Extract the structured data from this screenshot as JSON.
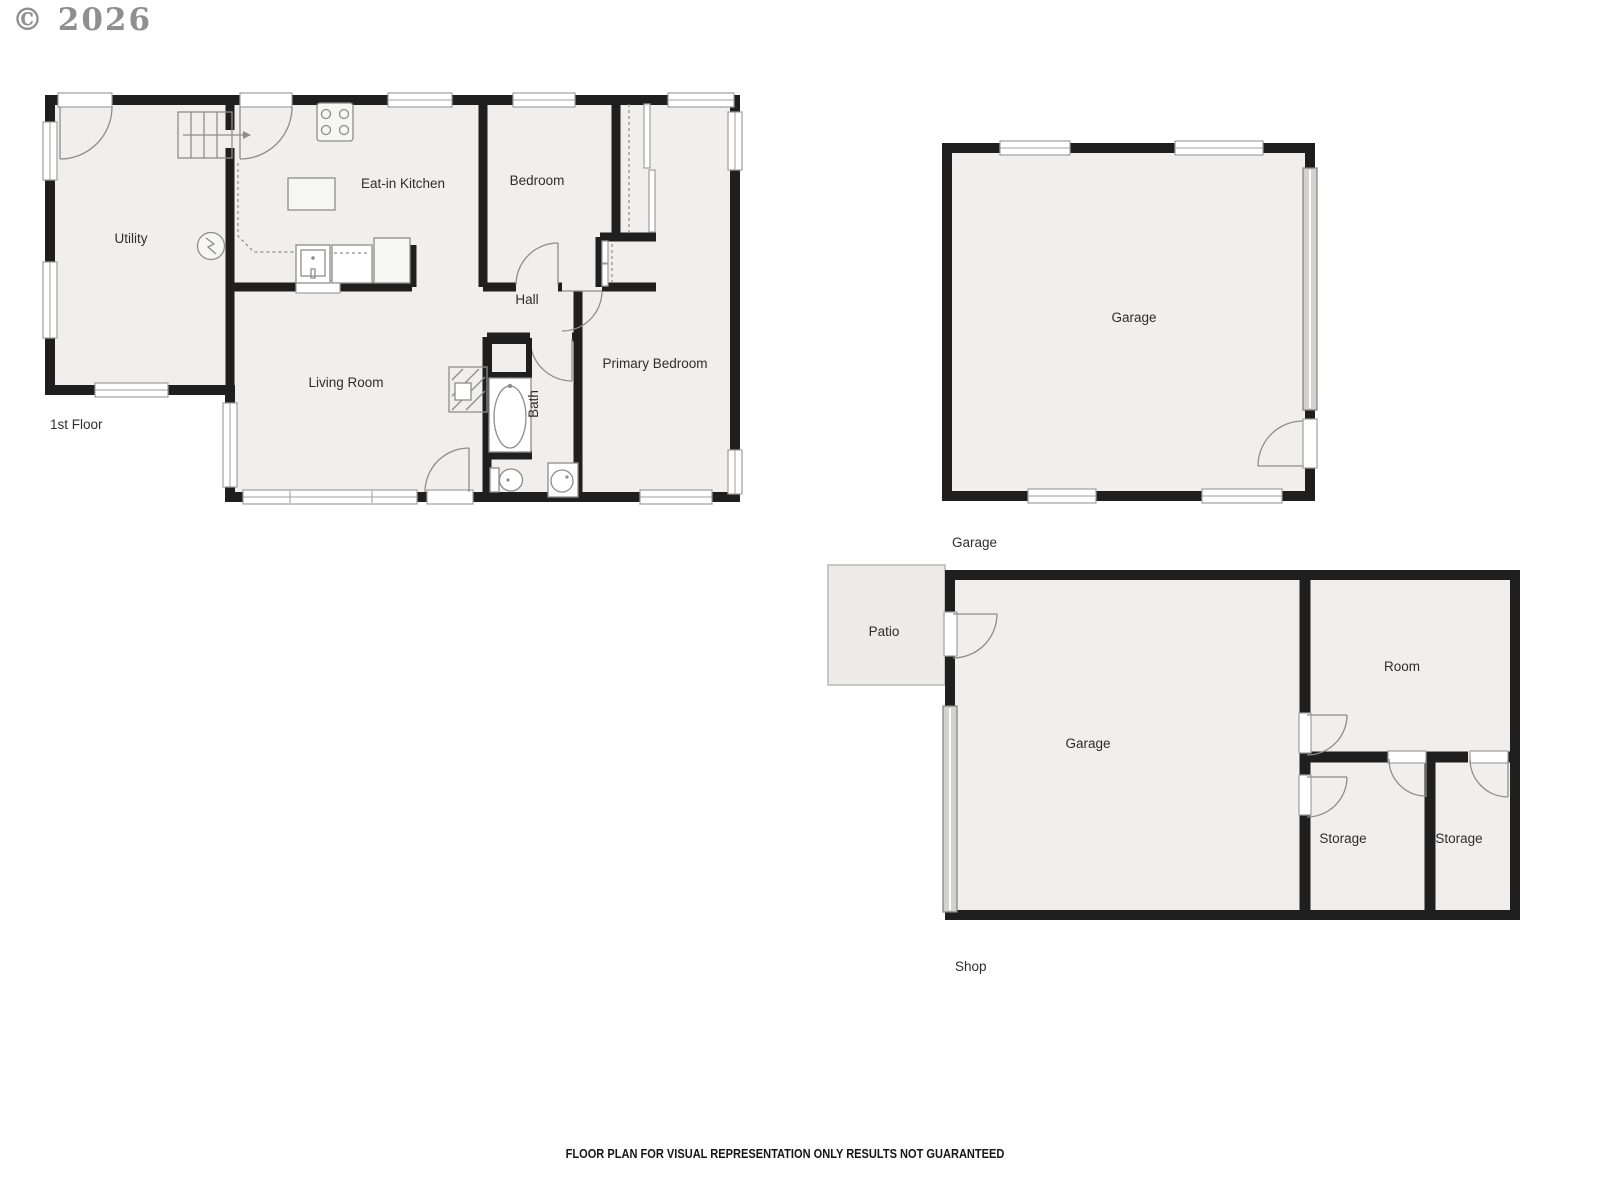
{
  "copyright": "© 2026",
  "disclaimer": "FLOOR PLAN FOR VISUAL REPRESENTATION ONLY RESULTS NOT GUARANTEED",
  "first_floor": {
    "label": "1st Floor",
    "rooms": {
      "utility": "Utility",
      "kitchen": "Eat-in Kitchen",
      "bedroom": "Bedroom",
      "hall": "Hall",
      "living_room": "Living Room",
      "bath": "Bath",
      "primary_bedroom": "Primary Bedroom"
    }
  },
  "garage_floor": {
    "label": "Garage",
    "rooms": {
      "garage": "Garage"
    }
  },
  "shop_floor": {
    "label": "Shop",
    "rooms": {
      "patio": "Patio",
      "garage": "Garage",
      "room": "Room",
      "storage_left": "Storage",
      "storage_right": "Storage"
    }
  },
  "colors": {
    "wall": "#1f1f1f",
    "room_fill": "#f0efed",
    "fixture_line": "#8d8d8d",
    "label_text": "#2d2d2d",
    "copyright_text": "#8f8f8f"
  }
}
